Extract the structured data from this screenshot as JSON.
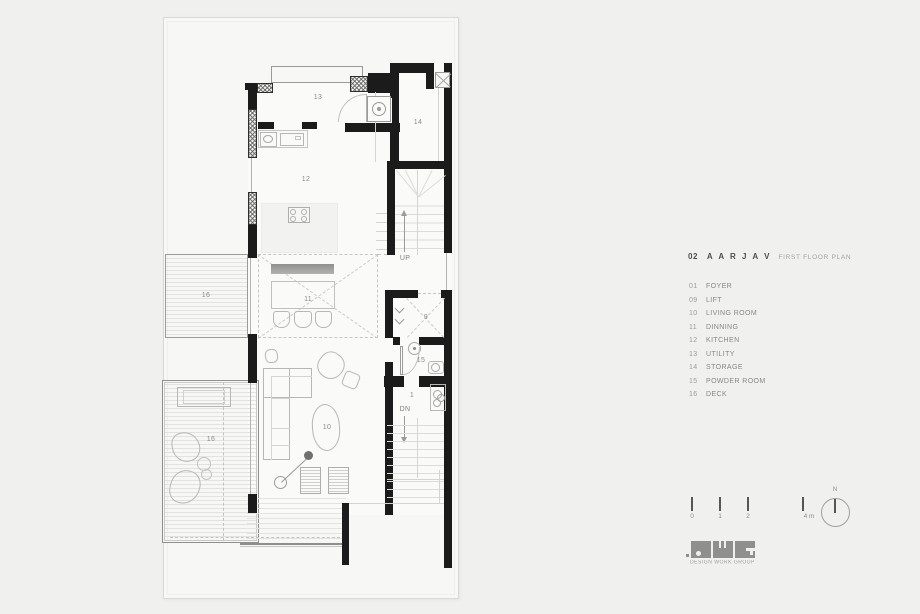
{
  "header": {
    "number": "02",
    "name": "A A R J A V",
    "subtitle": "FIRST FLOOR PLAN"
  },
  "legend": {
    "items": [
      {
        "num": "01",
        "label": "FOYER"
      },
      {
        "num": "09",
        "label": "LIFT"
      },
      {
        "num": "10",
        "label": "LIVING ROOM"
      },
      {
        "num": "11",
        "label": "DINNING"
      },
      {
        "num": "12",
        "label": "KITCHEN"
      },
      {
        "num": "13",
        "label": "UTILITY"
      },
      {
        "num": "14",
        "label": "STORAGE"
      },
      {
        "num": "15",
        "label": "POWDER ROOM"
      },
      {
        "num": "16",
        "label": "DECK"
      }
    ]
  },
  "plan": {
    "labels": [
      {
        "text": "13"
      },
      {
        "text": "14"
      },
      {
        "text": "12"
      },
      {
        "text": "16"
      },
      {
        "text": "11"
      },
      {
        "text": "9"
      },
      {
        "text": "15"
      },
      {
        "text": "1"
      },
      {
        "text": "10"
      },
      {
        "text": "16"
      }
    ],
    "up": "UP",
    "dn": "DN"
  },
  "scale": {
    "t0": "0",
    "t1": "1",
    "t2": "2",
    "t3": "4 m"
  },
  "north": {
    "label": "N"
  },
  "logo": {
    "caption": "DESIGN WORK GROUP"
  },
  "colors": {
    "wall": "#1b1b1b",
    "background": "#f0f0ee",
    "sheet": "#f7f7f6",
    "furniture_line": "#b7b7b5",
    "text_gray": "#8b8b89",
    "logo_gray": "#8f8f8d"
  }
}
